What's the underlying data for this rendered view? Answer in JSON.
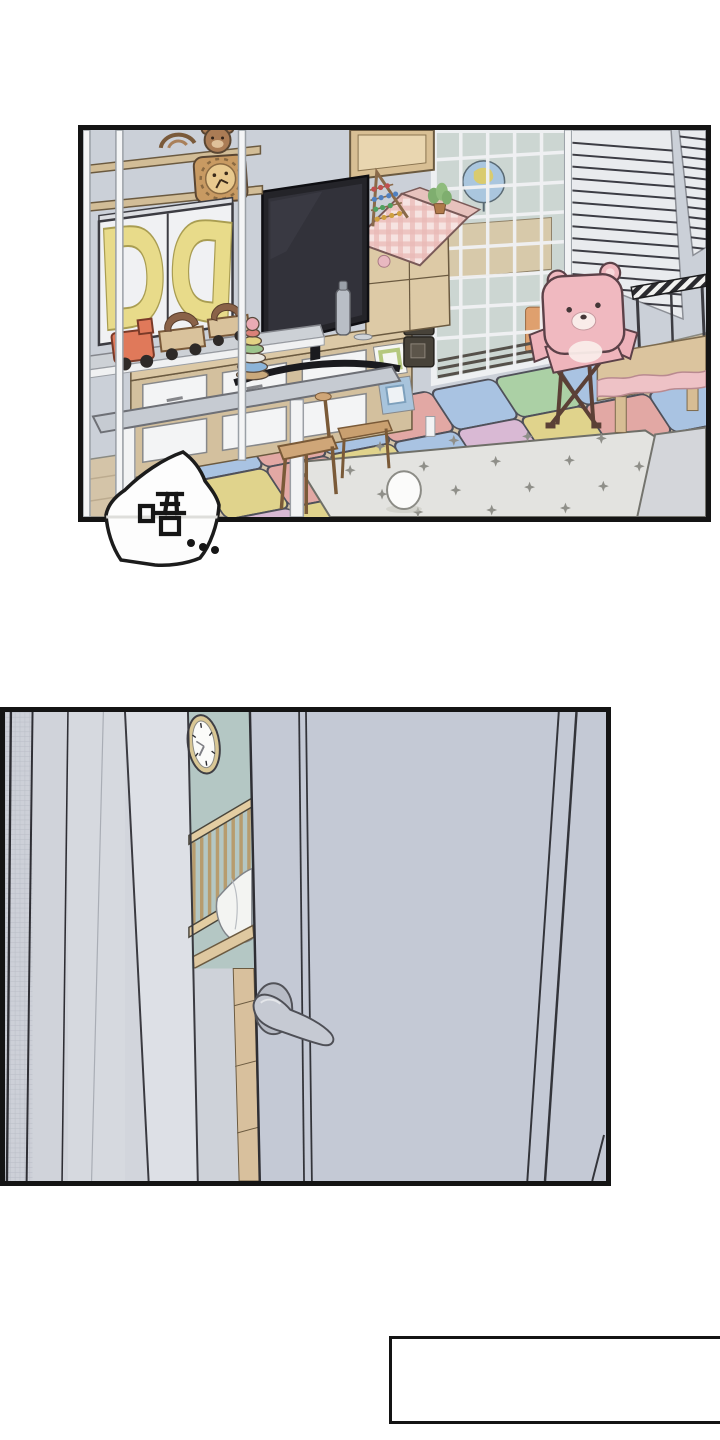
{
  "page": {
    "background_color": "#ffffff",
    "panel_border_color": "#141414"
  },
  "speech_bubble": {
    "text": "唔..."
  },
  "playroom_panel": {
    "cabinet_letters": [
      "D",
      "D"
    ],
    "colors": {
      "wall": "#cbd0d8",
      "floor": "#d4c4a8",
      "tv_black": "#242429",
      "bear_chair_pink": "#f0b9c0",
      "dollhouse_roof_pink": "#eecfcb",
      "cabinet_letter_yellow": "#e8db8a",
      "star_rug": "#e3e3e0",
      "mat_palette": [
        "#a9c3e2",
        "#e2a8a4",
        "#e0d38c",
        "#abd0a5",
        "#d9b9d4",
        "#89c0b4"
      ]
    }
  },
  "door_panel": {
    "colors": {
      "door": "#c4c9d5",
      "door_frame": "#d3d6dd",
      "nursery_wall": "#b4c7c4",
      "crib_wood": "#e3cda2",
      "handle_metal": "#c6cad3",
      "clock_rim": "#d9c795"
    }
  },
  "caption_box": {
    "text": ""
  }
}
